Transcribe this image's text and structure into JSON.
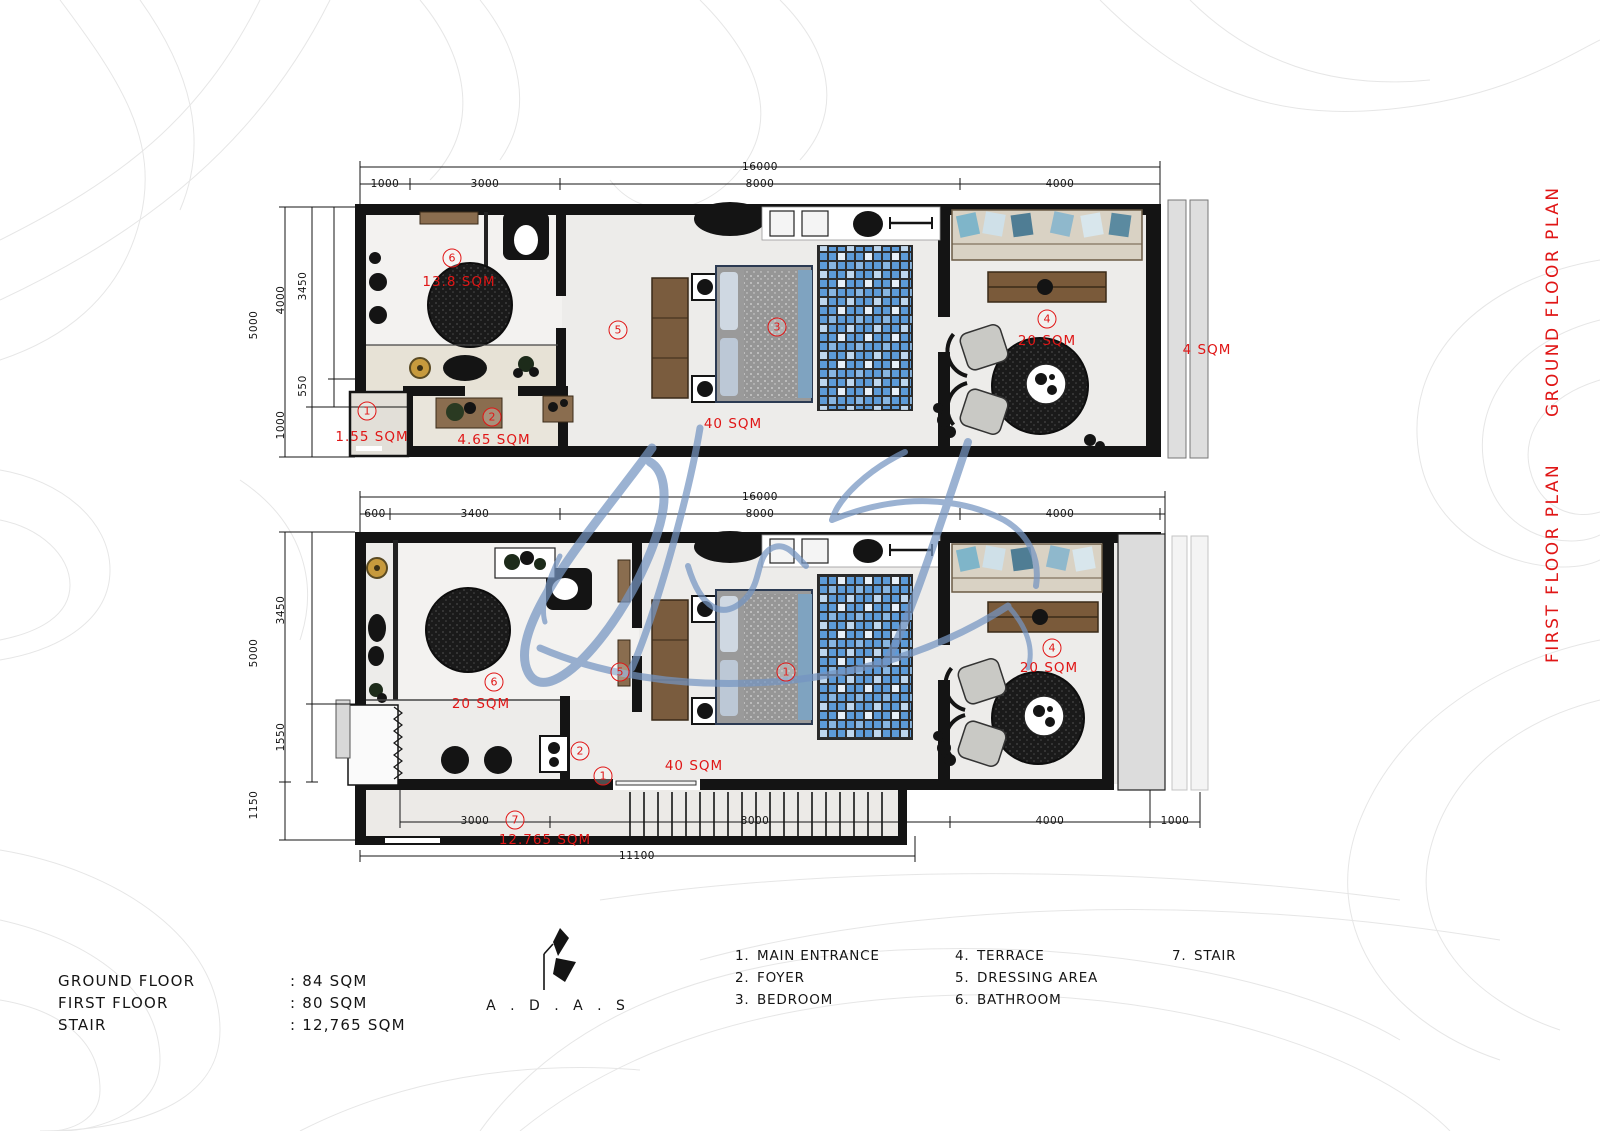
{
  "colors": {
    "accent_red": "#e01616",
    "wall_black": "#141414",
    "watermark_blue": "#7595c2",
    "rug_blue": "#5d9bd8",
    "floor_gray": "#edecea"
  },
  "side_titles": {
    "ground": "GROUND FLOOR PLAN",
    "first": "FIRST FLOOR PLAN"
  },
  "ground_floor": {
    "dims": {
      "total_top": "16000",
      "top_a": "1000",
      "top_b": "3000",
      "top_c": "8000",
      "top_d": "4000",
      "left_total": "5000",
      "left_a": "4000",
      "left_b": "3450",
      "left_c": "550",
      "left_d": "1000"
    },
    "labels": {
      "bathroom_num": "6",
      "bathroom_area": "13.8 SQM",
      "dressing_num": "5",
      "entrance_num": "1",
      "entrance_area": "1.55 SQM",
      "foyer_num": "2",
      "foyer_area": "4.65 SQM",
      "bedroom_num": "3",
      "bedroom_area": "40 SQM",
      "terrace_num": "4",
      "terrace_area": "20 SQM",
      "balcony_area": "4 SQM"
    }
  },
  "first_floor": {
    "dims": {
      "total_top": "16000",
      "top_a": "600",
      "top_b": "3400",
      "top_c": "8000",
      "top_d": "4000",
      "left_total": "5000",
      "left_a": "3450",
      "left_b": "1550",
      "left_c": "1150",
      "bottom_a": "3000",
      "bottom_b": "8000",
      "bottom_c": "4000",
      "bottom_d": "1000",
      "bottom_total": "11100"
    },
    "labels": {
      "bathroom_num": "6",
      "bathroom_area": "20 SQM",
      "dressing_num": "5",
      "foyer_num": "2",
      "entrance_num": "1",
      "bedroom_num": "1",
      "bedroom_area": "40 SQM",
      "terrace_num": "4",
      "terrace_area": "20 SQM",
      "stair_num": "7",
      "stair_area": "12.765 SQM"
    }
  },
  "legend": {
    "col1": [
      {
        "num": "1.",
        "label": "MAIN ENTRANCE"
      },
      {
        "num": "2.",
        "label": "FOYER"
      },
      {
        "num": "3.",
        "label": "BEDROOM"
      }
    ],
    "col2": [
      {
        "num": "4.",
        "label": "TERRACE"
      },
      {
        "num": "5.",
        "label": "DRESSING AREA"
      },
      {
        "num": "6.",
        "label": "BATHROOM"
      }
    ],
    "col3": [
      {
        "num": "7.",
        "label": "STAIR"
      }
    ]
  },
  "stats": {
    "rows": [
      {
        "label": "GROUND FLOOR",
        "value": ": 84 SQM"
      },
      {
        "label": "FIRST FLOOR",
        "value": ": 80 SQM"
      },
      {
        "label": "STAIR",
        "value": ": 12,765 SQM"
      }
    ]
  },
  "logo": {
    "text": "A . D . A . S"
  },
  "watermark": {
    "line1": "Interior",
    "line2": "Real Estate"
  }
}
